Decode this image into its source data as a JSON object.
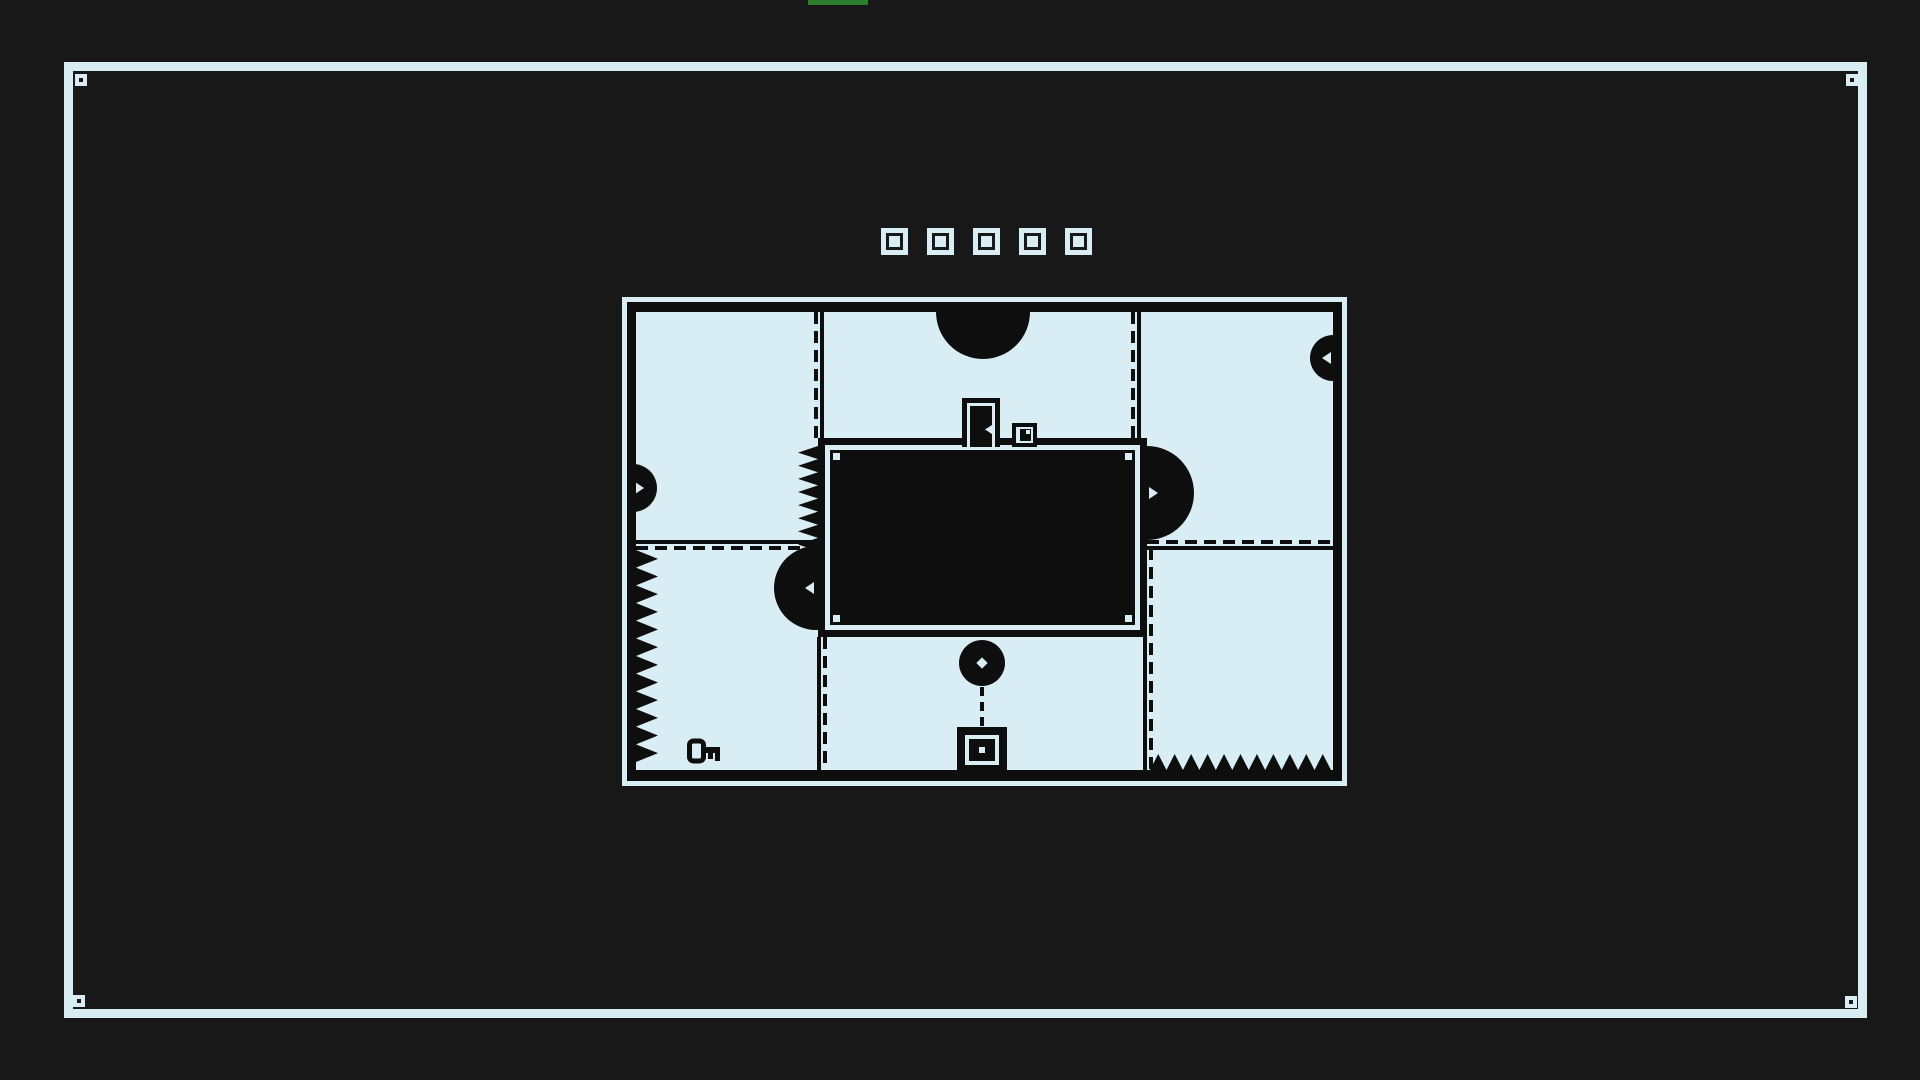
{
  "screen": {
    "background": "#181818",
    "ink": "#0e0e0e",
    "paper": "#d9eef4",
    "accent_green": "#2c7e2c"
  },
  "progress_bar": {
    "x": 808,
    "y": 0,
    "width": 60,
    "height": 5
  },
  "outer_frame": {
    "x": 64,
    "y": 62,
    "width": 1803,
    "height": 956,
    "thickness": 9,
    "marker_size": 12,
    "corner_markers": [
      {
        "x": 75,
        "y": 74
      },
      {
        "x": 1846,
        "y": 74
      },
      {
        "x": 73,
        "y": 995
      },
      {
        "x": 1845,
        "y": 996
      }
    ]
  },
  "level_indicators": {
    "x": 881,
    "y": 228,
    "size": 27,
    "gap": 19,
    "items": [
      {
        "state": "filled"
      },
      {
        "state": "filled"
      },
      {
        "state": "filled"
      },
      {
        "state": "filled"
      },
      {
        "state": "filled"
      }
    ]
  },
  "map": {
    "x": 622,
    "y": 297,
    "width": 725,
    "height": 489,
    "outline_thickness": 5,
    "wall_thickness": {
      "top": 10,
      "right": 9,
      "bottom": 11,
      "left": 9
    },
    "interior": {
      "width": 697,
      "height": 458
    },
    "central_block": {
      "x": 182,
      "y": 126,
      "width": 329,
      "height": 199
    },
    "dividers": [
      {
        "orient": "v",
        "x": 178,
        "y": 0,
        "length": 126,
        "first": "dash"
      },
      {
        "orient": "v",
        "x": 495,
        "y": 0,
        "length": 126,
        "first": "dash"
      },
      {
        "orient": "h",
        "x": 0,
        "y": 228,
        "length": 182,
        "first": "solid"
      },
      {
        "orient": "h",
        "x": 511,
        "y": 228,
        "length": 186,
        "first": "dash"
      },
      {
        "orient": "v",
        "x": 181,
        "y": 325,
        "length": 133,
        "first": "solid"
      },
      {
        "orient": "v",
        "x": 507,
        "y": 236,
        "length": 222,
        "first": "solid"
      }
    ],
    "saws": [
      {
        "cx": 347,
        "cy": 0,
        "r": 47,
        "notch": "down",
        "mount": "ceiling"
      },
      {
        "cx": 697,
        "cy": 46,
        "r": 23,
        "notch": "left",
        "mount": "right-wall"
      },
      {
        "cx": -3,
        "cy": 176,
        "r": 24,
        "notch": "right",
        "mount": "left-wall"
      },
      {
        "cx": 511,
        "cy": 181,
        "r": 47,
        "notch": "right",
        "mount": "block-right"
      },
      {
        "cx": 180,
        "cy": 276,
        "r": 42,
        "notch": "left",
        "mount": "block-left"
      },
      {
        "cx": 346,
        "cy": 351,
        "r": 23,
        "notch": "center",
        "mount": "free"
      }
    ],
    "spike_strips": [
      {
        "x": 0,
        "y": 238,
        "width": 22,
        "height": 212,
        "teeth": 12,
        "dir": "right"
      },
      {
        "x": 162,
        "y": 134,
        "width": 20,
        "height": 105,
        "teeth": 8,
        "dir": "left"
      },
      {
        "x": 514,
        "y": 442,
        "width": 181,
        "height": 16,
        "teeth": 11,
        "dir": "up"
      }
    ],
    "door": {
      "x": 326,
      "y": 86,
      "width": 38,
      "height": 49
    },
    "crate": {
      "x": 376,
      "y": 111,
      "width": 25,
      "height": 24
    },
    "key": {
      "x": 50,
      "y": 426,
      "width": 38,
      "height": 26
    },
    "connector": {
      "x": 344,
      "y": 375,
      "width": 4,
      "height": 40
    },
    "socket": {
      "x": 321,
      "y": 415,
      "width": 50,
      "height": 46
    }
  }
}
